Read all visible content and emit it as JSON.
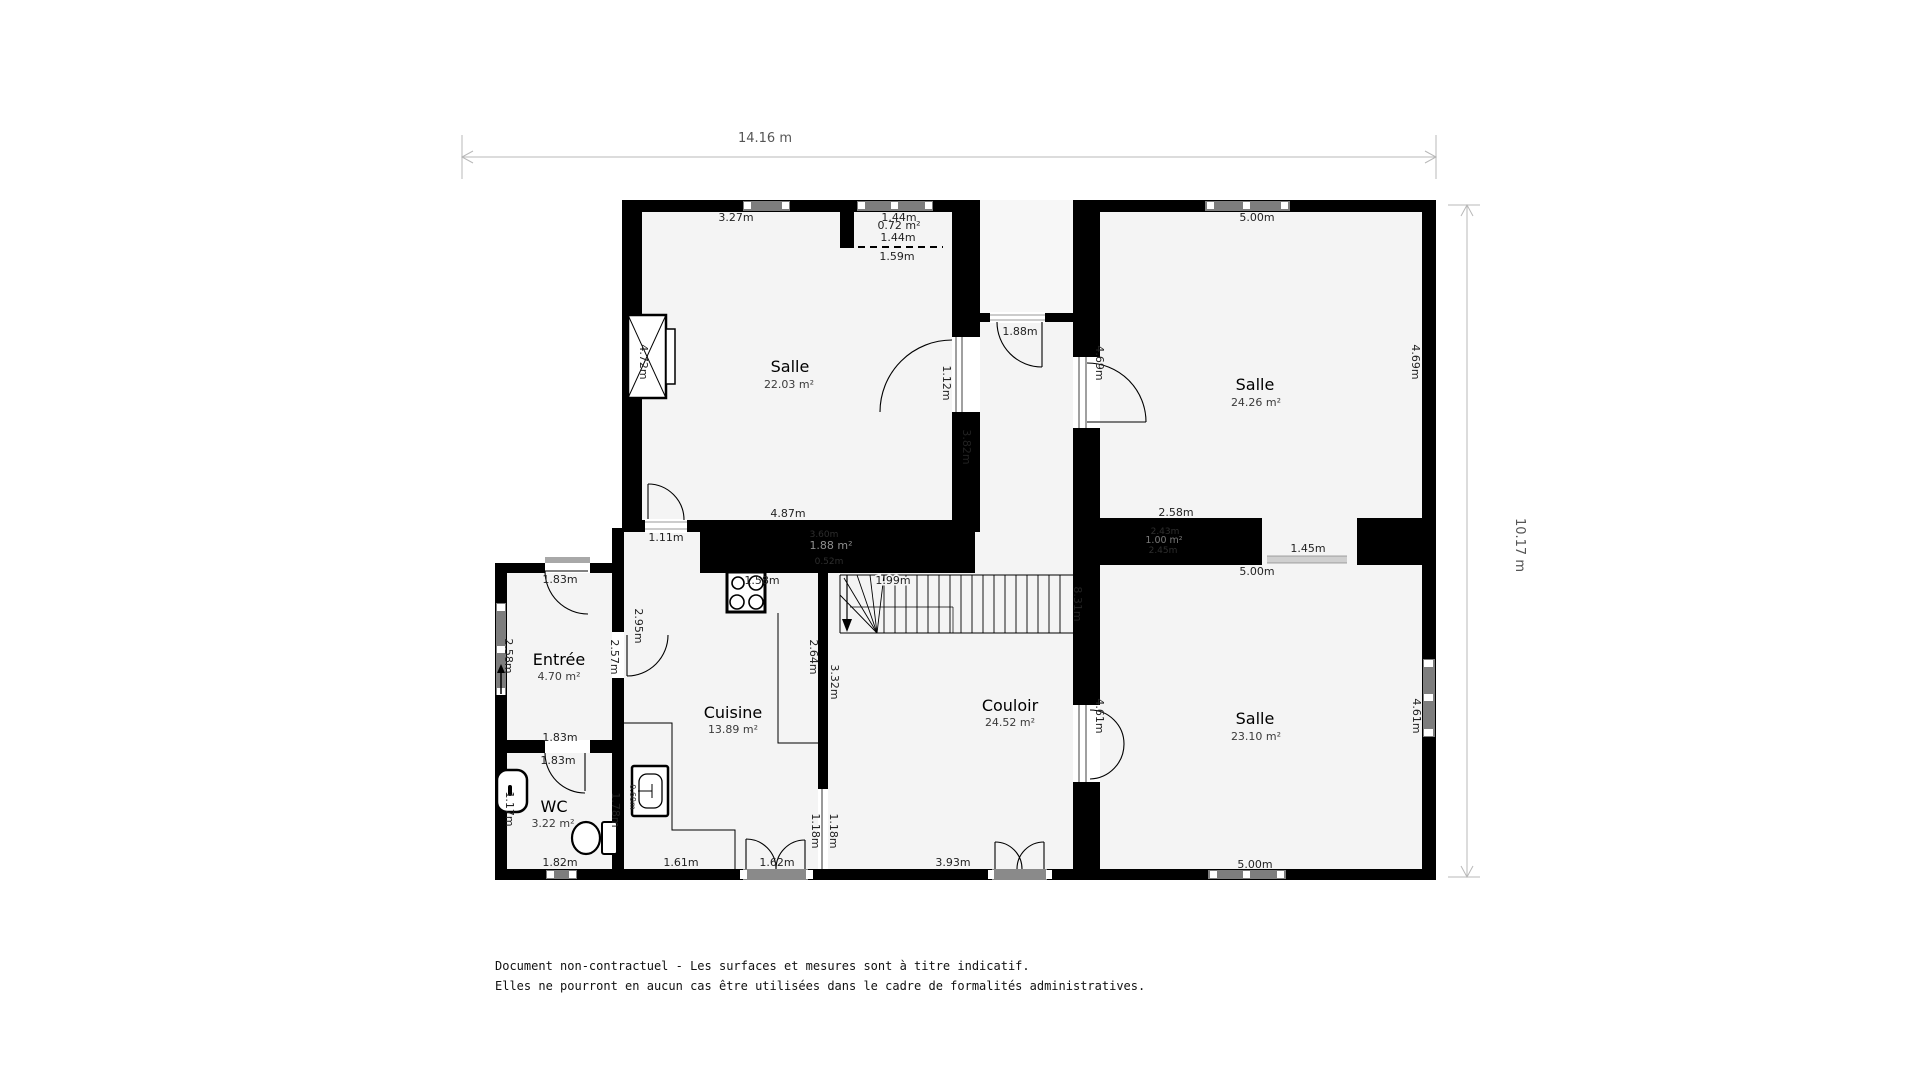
{
  "dims": {
    "width_label": "14.16 m",
    "height_label": "10.17 m"
  },
  "rooms": {
    "salle1": {
      "name": "Salle",
      "area": "22.03 m²"
    },
    "salle2": {
      "name": "Salle",
      "area": "24.26 m²"
    },
    "salle3": {
      "name": "Salle",
      "area": "23.10 m²"
    },
    "cuisine": {
      "name": "Cuisine",
      "area": "13.89 m²"
    },
    "couloir": {
      "name": "Couloir",
      "area": "24.52 m²"
    },
    "entree": {
      "name": "Entrée",
      "area": "4.70 m²"
    },
    "wc": {
      "name": "WC",
      "area": "3.22 m²"
    }
  },
  "m": {
    "s1_top": "3.27m",
    "s1_left": "4.72m",
    "s1_bottom": "4.87m",
    "s1_right": "3.82m",
    "s1_door_bottom": "1.11m",
    "s1_door_right": "1.12m",
    "niche_w1": "1.44m",
    "niche_area": "0.72 m²",
    "niche_w2": "1.44m",
    "niche_dash": "1.59m",
    "corridor_door_top": "1.88m",
    "s2_top": "5.00m",
    "s2_left": "4.69m",
    "s2_right": "4.69m",
    "s2_bottom_seg": "2.58m",
    "passage": "1.45m",
    "closet1_w": "3.60m",
    "closet1_area": "1.88 m²",
    "closet1_d": "0.52m",
    "closet2_w": "2.43m",
    "closet2_area": "1.00 m²",
    "closet2_d": "2.45m",
    "s3_top": "5.00m",
    "s3_left": "4.61m",
    "s3_right": "4.61m",
    "s3_bottom": "5.00m",
    "stairs": "1.99m",
    "stove": "1.58m",
    "couloir_right": "8.31m",
    "couloir_bottom": "3.93m",
    "couloir_left": "3.32m",
    "cuisine_left_up": "2.95m",
    "cuisine_left": "2.64m",
    "cuisine_bottom1": "1.61m",
    "cuisine_door": "1.62m",
    "pass1": "1.18m",
    "pass2": "1.18m",
    "entree_left": "2.58m",
    "entree_right": "2.57m",
    "entree_door_top": "1.83m",
    "entree_bottom": "1.83m",
    "wc_door": "1.83m",
    "wc_left": "1.17m",
    "wc_right": "1.78m",
    "wc_window": "1.82m",
    "sink": "0.60m"
  },
  "footer": {
    "line1": "Document non-contractuel - Les surfaces et mesures sont à titre indicatif.",
    "line2": "Elles ne pourront en aucun cas être utilisées dans le cadre de formalités administratives."
  }
}
